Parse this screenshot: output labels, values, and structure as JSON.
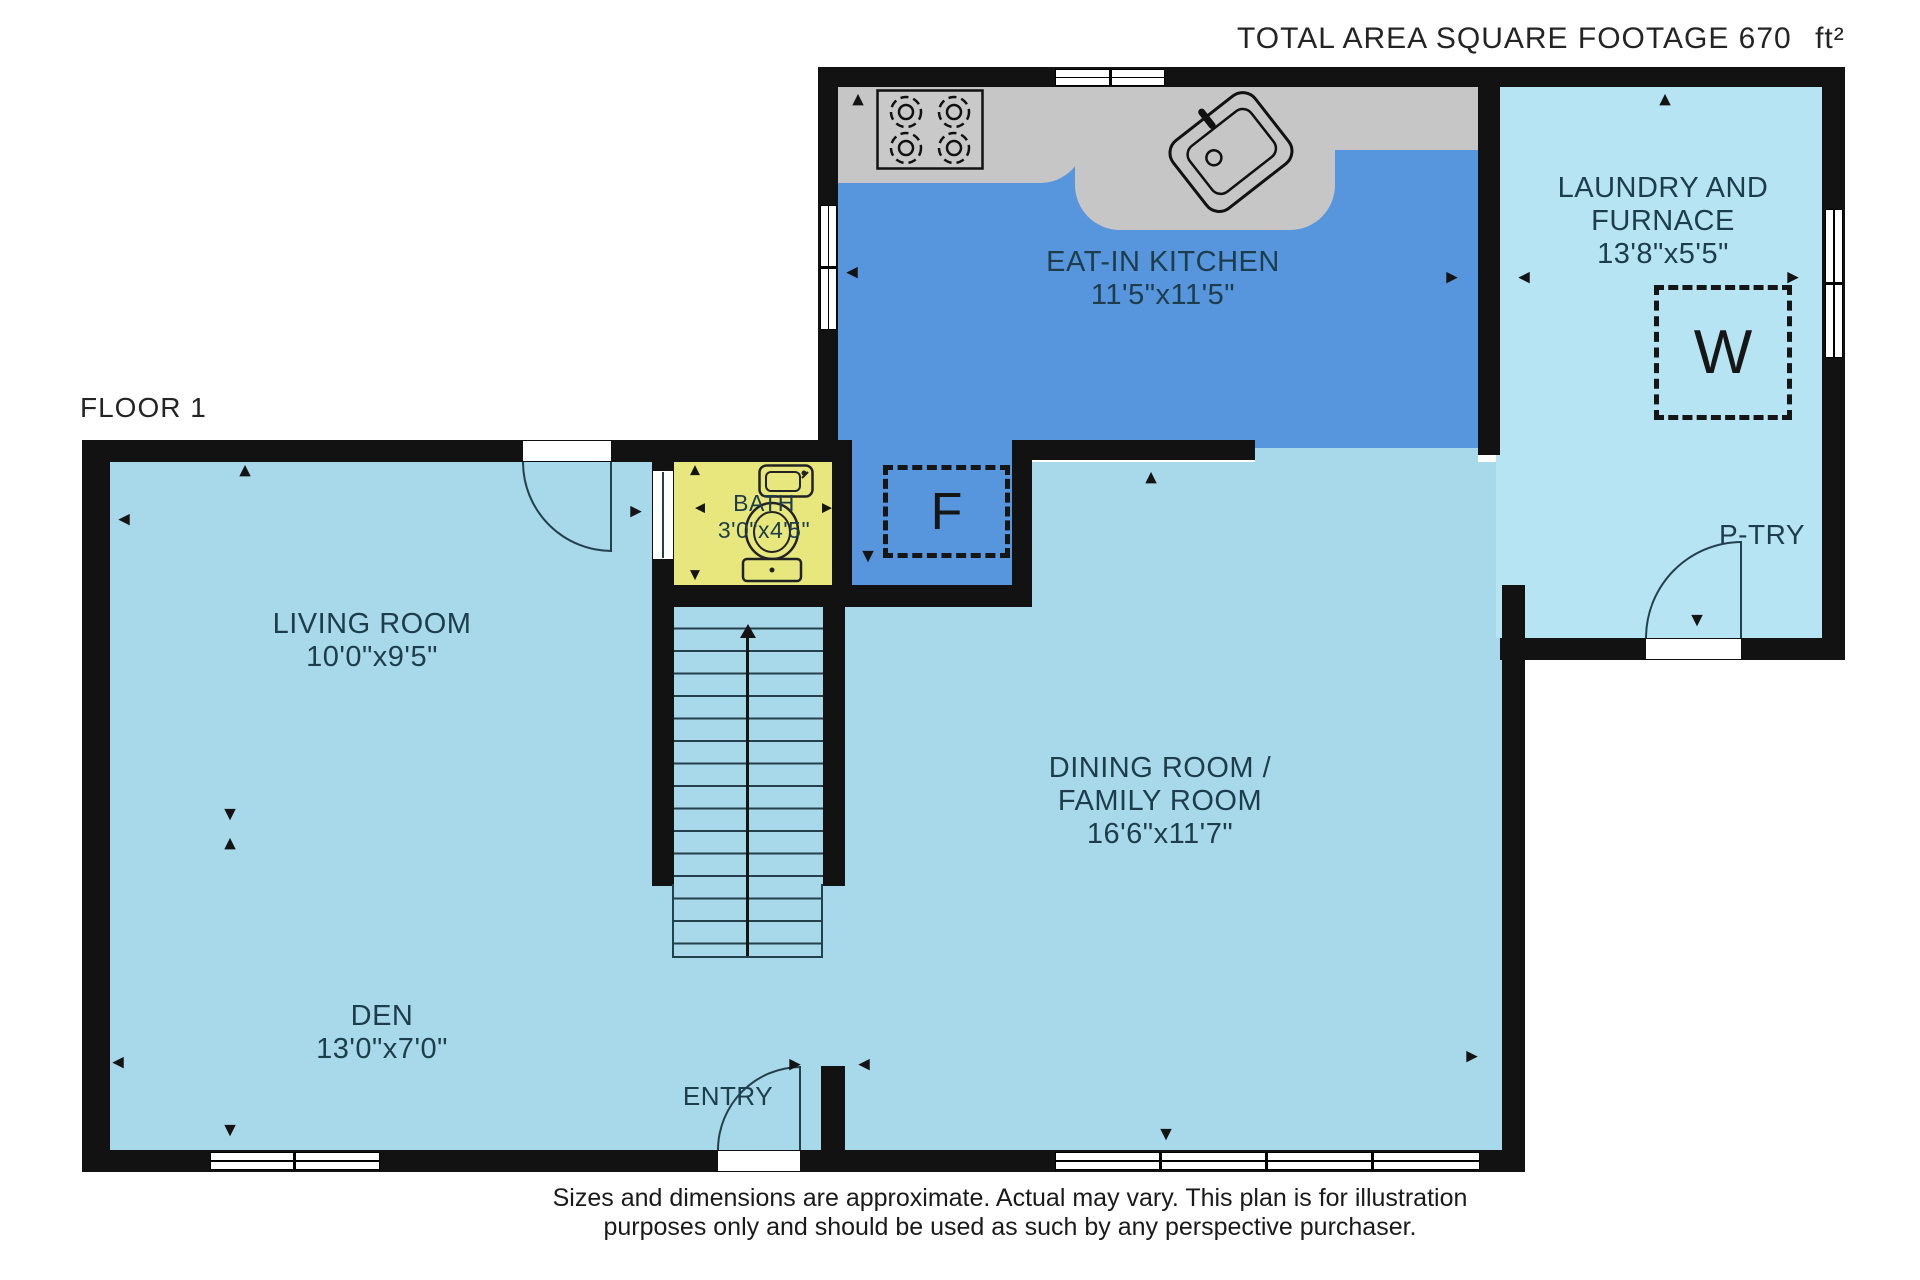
{
  "title": {
    "text": "TOTAL AREA SQUARE FOOTAGE 670",
    "unit": "ft²"
  },
  "floor_label": "FLOOR 1",
  "rooms": {
    "kitchen": {
      "name": "EAT-IN KITCHEN",
      "dims": "11'5\"x11'5\""
    },
    "laundry": {
      "name_line1": "LAUNDRY AND",
      "name_line2": "FURNACE",
      "dims": "13'8\"x5'5\""
    },
    "bath": {
      "name": "BATH",
      "dims": "3'0\"x4'5\""
    },
    "living": {
      "name": "LIVING ROOM",
      "dims": "10'0\"x9'5\""
    },
    "dining": {
      "name_line1": "DINING ROOM /",
      "name_line2": "FAMILY ROOM",
      "dims": "16'6\"x11'7\""
    },
    "den": {
      "name": "DEN",
      "dims": "13'0\"x7'0\""
    },
    "pantry": {
      "name": "P-TRY"
    },
    "entry": {
      "name": "ENTRY"
    }
  },
  "appliances": {
    "fridge": "F",
    "washer": "W"
  },
  "icons": {
    "up": "▲",
    "down": "▼",
    "left": "◀",
    "right": "▶"
  },
  "disclaimer": {
    "line1": "Sizes and dimensions are approximate. Actual may vary. This plan is for illustration",
    "line2": "purposes only and should be used as such by any perspective purchaser."
  },
  "colors": {
    "floor_main": "#a8d9eb",
    "floor_laundry": "#b6e4f2",
    "floor_kitchen": "#5795dd",
    "floor_bath": "#e7e77e",
    "counter": "#c6c6c6",
    "wall": "#121212",
    "label_text": "#1d3d4c"
  }
}
